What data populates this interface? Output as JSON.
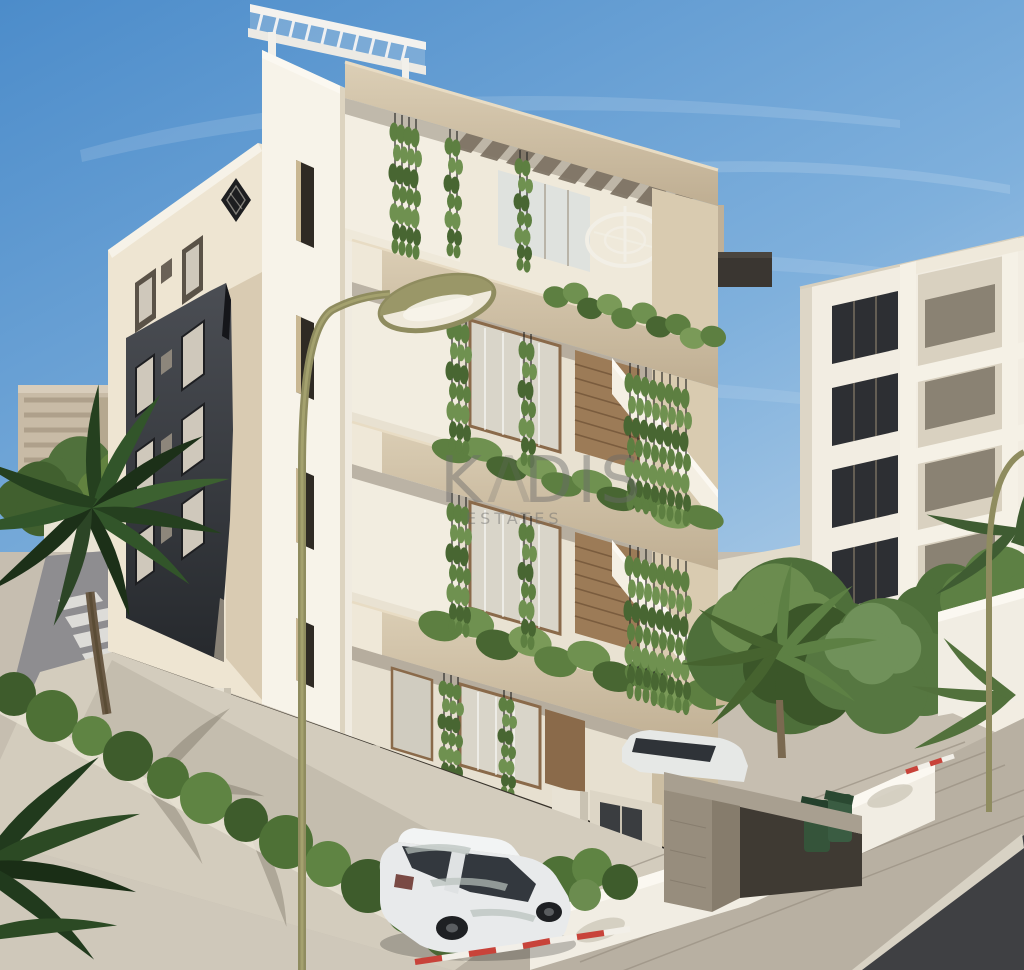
{
  "scene": {
    "label": "3D exterior render of a modern five-storey apartment building on a sunny street",
    "watermarked": true
  },
  "watermark": {
    "brand_left": "K",
    "brand_mark": "Λ",
    "brand_right": "DIS",
    "subtitle": "ESTATES",
    "color": "#6a6a6a"
  },
  "logo": {
    "shape": "diamond-monogram",
    "color": "#1d1e20"
  },
  "palette": {
    "sky_top": "#4c8cca",
    "sky_mid": "#7fb0dc",
    "sky_horizon": "#c3d9ec",
    "facade_cream": "#eee5d2",
    "facade_white": "#f7f3e9",
    "slab_beige": "#cdbb9e",
    "accent_panel_dark": "#34373c",
    "wood_tone": "#9c7b57",
    "glass_dark": "#2e3237",
    "foliage_green": "#4e6f3a",
    "hedge_green": "#5d7f41",
    "palm_dark": "#2c4526",
    "lamp_olive": "#8f8c5f",
    "pavement_grey": "#b8b0a2",
    "asphalt_dark": "#3f4043",
    "barrier_red": "#c8433a",
    "bin_green": "#35543a",
    "taillight_red": "#b13a32"
  }
}
